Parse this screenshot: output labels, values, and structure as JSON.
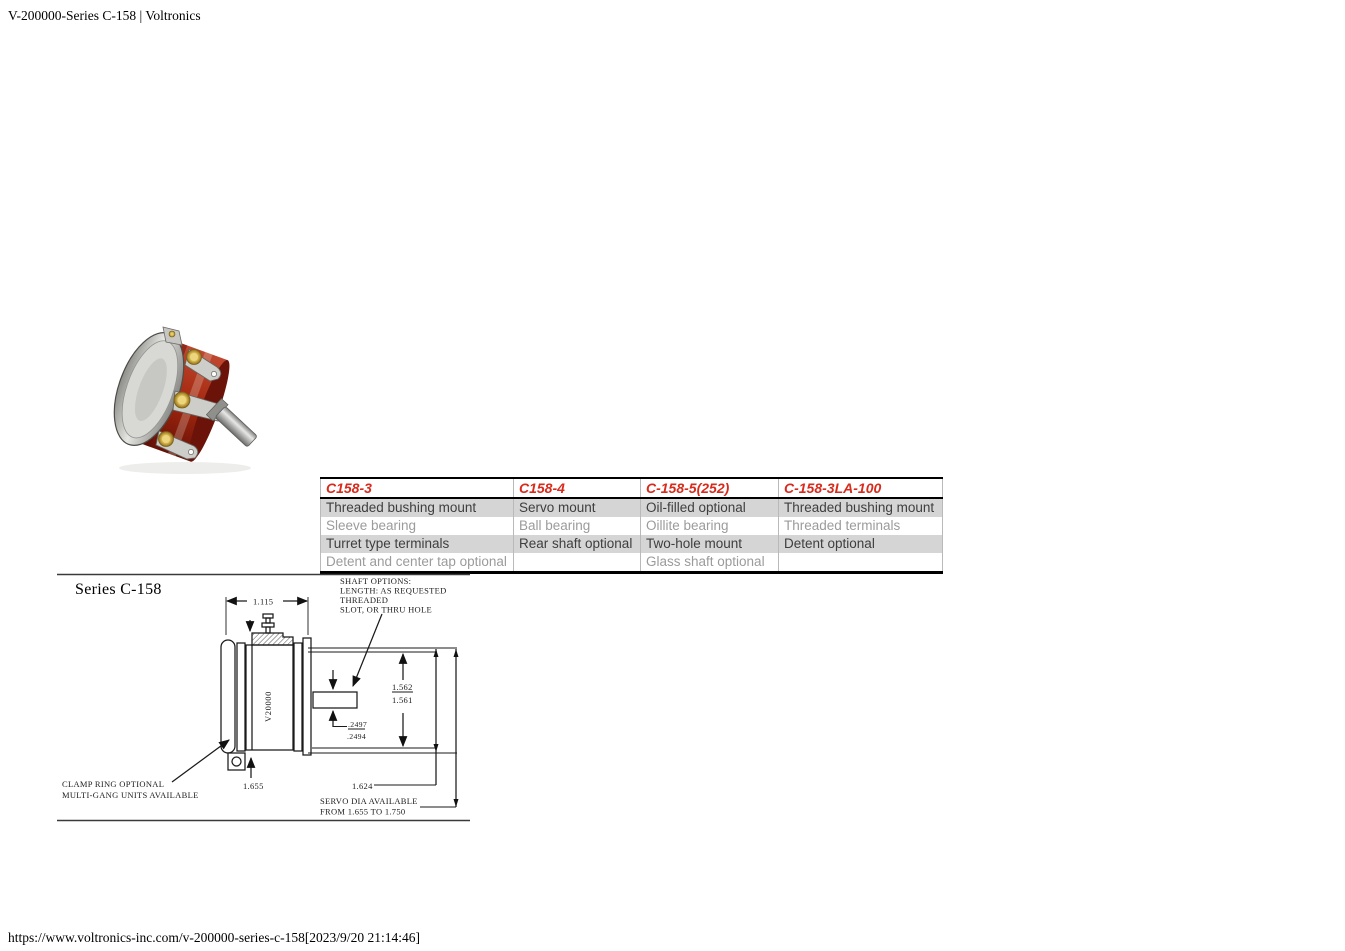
{
  "window": {
    "title": "V-200000-Series C-158 | Voltronics",
    "footer_url": "https://www.voltronics-inc.com/v-200000-series-c-158[2023/9/20 21:14:46]"
  },
  "colors": {
    "accent_red": "#d92a1c",
    "row_shade_gray": "#d5d5d5",
    "row_text_dark": "#3e3e3e",
    "row_text_light": "#9b9b9b"
  },
  "photo": {
    "name": "C-158 potentiometer product photo"
  },
  "spec_table": {
    "headers": [
      "C158-3",
      "C158-4",
      "C-158-5(252)",
      "C-158-3LA-100"
    ],
    "rows": [
      [
        "Threaded bushing mount",
        "Servo mount",
        "Oil-filled optional",
        "Threaded bushing mount"
      ],
      [
        "Sleeve bearing",
        "Ball bearing",
        "Oillite bearing",
        "Threaded terminals"
      ],
      [
        "Turret type terminals",
        "Rear shaft optional",
        "Two-hole mount",
        "Detent optional"
      ],
      [
        "Detent and center tap optional",
        "",
        "Glass shaft optional",
        ""
      ]
    ]
  },
  "drawing": {
    "title": "Series C-158",
    "body_label": "V20000",
    "shaft_options": [
      "SHAFT OPTIONS:",
      "LENGTH: AS REQUESTED",
      "THREADED",
      "SLOT, OR THRU HOLE"
    ],
    "clamp_note": [
      "CLAMP RING OPTIONAL",
      "MULTI-GANG UNITS AVAILABLE"
    ],
    "servo_note": [
      "SERVO DIA AVAILABLE",
      "FROM 1.655 TO 1.750"
    ],
    "dims": {
      "housing_width": "1.115",
      "dia_upper": "1.562",
      "dia_lower": "1.561",
      "shaft_dia_upper": ".2497",
      "shaft_dia_lower": ".2494",
      "flange_dia": "1.655",
      "servo_pilot_dia": "1.624"
    }
  }
}
